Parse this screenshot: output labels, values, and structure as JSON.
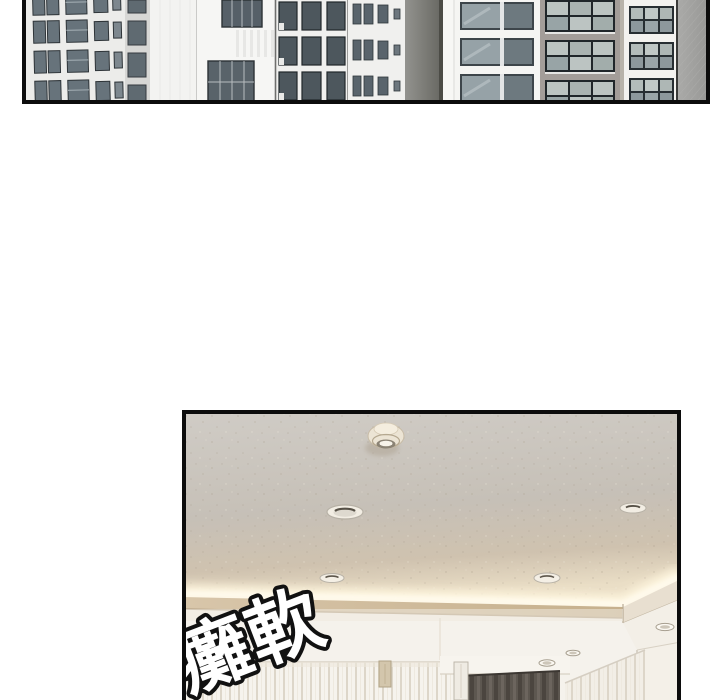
{
  "page": {
    "background": "#ffffff",
    "kind": "webtoon comic page, two borderless-gutter panels"
  },
  "panel_city": {
    "alt": "Exterior panel: white and grey high-rise apartment buildings with grids of dark windows, cropped at the top of the page",
    "border_color": "#0c0c0c"
  },
  "panel_interior": {
    "alt": "Interior panel looking up at a speckled taupe ceiling with a smoke detector, recessed downlights, warm cove lighting, white curtains and a dark grey center curtain",
    "border_color": "#0c0c0c",
    "recessed_light_count": "7",
    "fixtures": [
      "smoke-detector",
      "recessed-lights",
      "cove-light",
      "curtains",
      "wall-switch"
    ]
  },
  "sfx": {
    "text": "癱軟",
    "fill": "#ffffff",
    "outline": "#111111"
  },
  "colors": {
    "panel_border": "#0c0c0c",
    "sky": "#fdfdfd",
    "building_white": "#f2f2f0",
    "building_grey": "#a5a5a3",
    "window_glass_dark": "#5b666c",
    "window_glass_light": "#bcc4c2",
    "window_frame": "#272e32",
    "ceiling_top": "#d0ccc6",
    "ceiling_warm": "#c8bfb2",
    "cove_glow": "#fdf4dd",
    "soffit": "#d2bfa2",
    "wall_white": "#f5f2ec",
    "curtain_fold": "#ddd6c9",
    "dark_curtain": "#5d5750",
    "switch_plate": "#d3c6ac"
  }
}
